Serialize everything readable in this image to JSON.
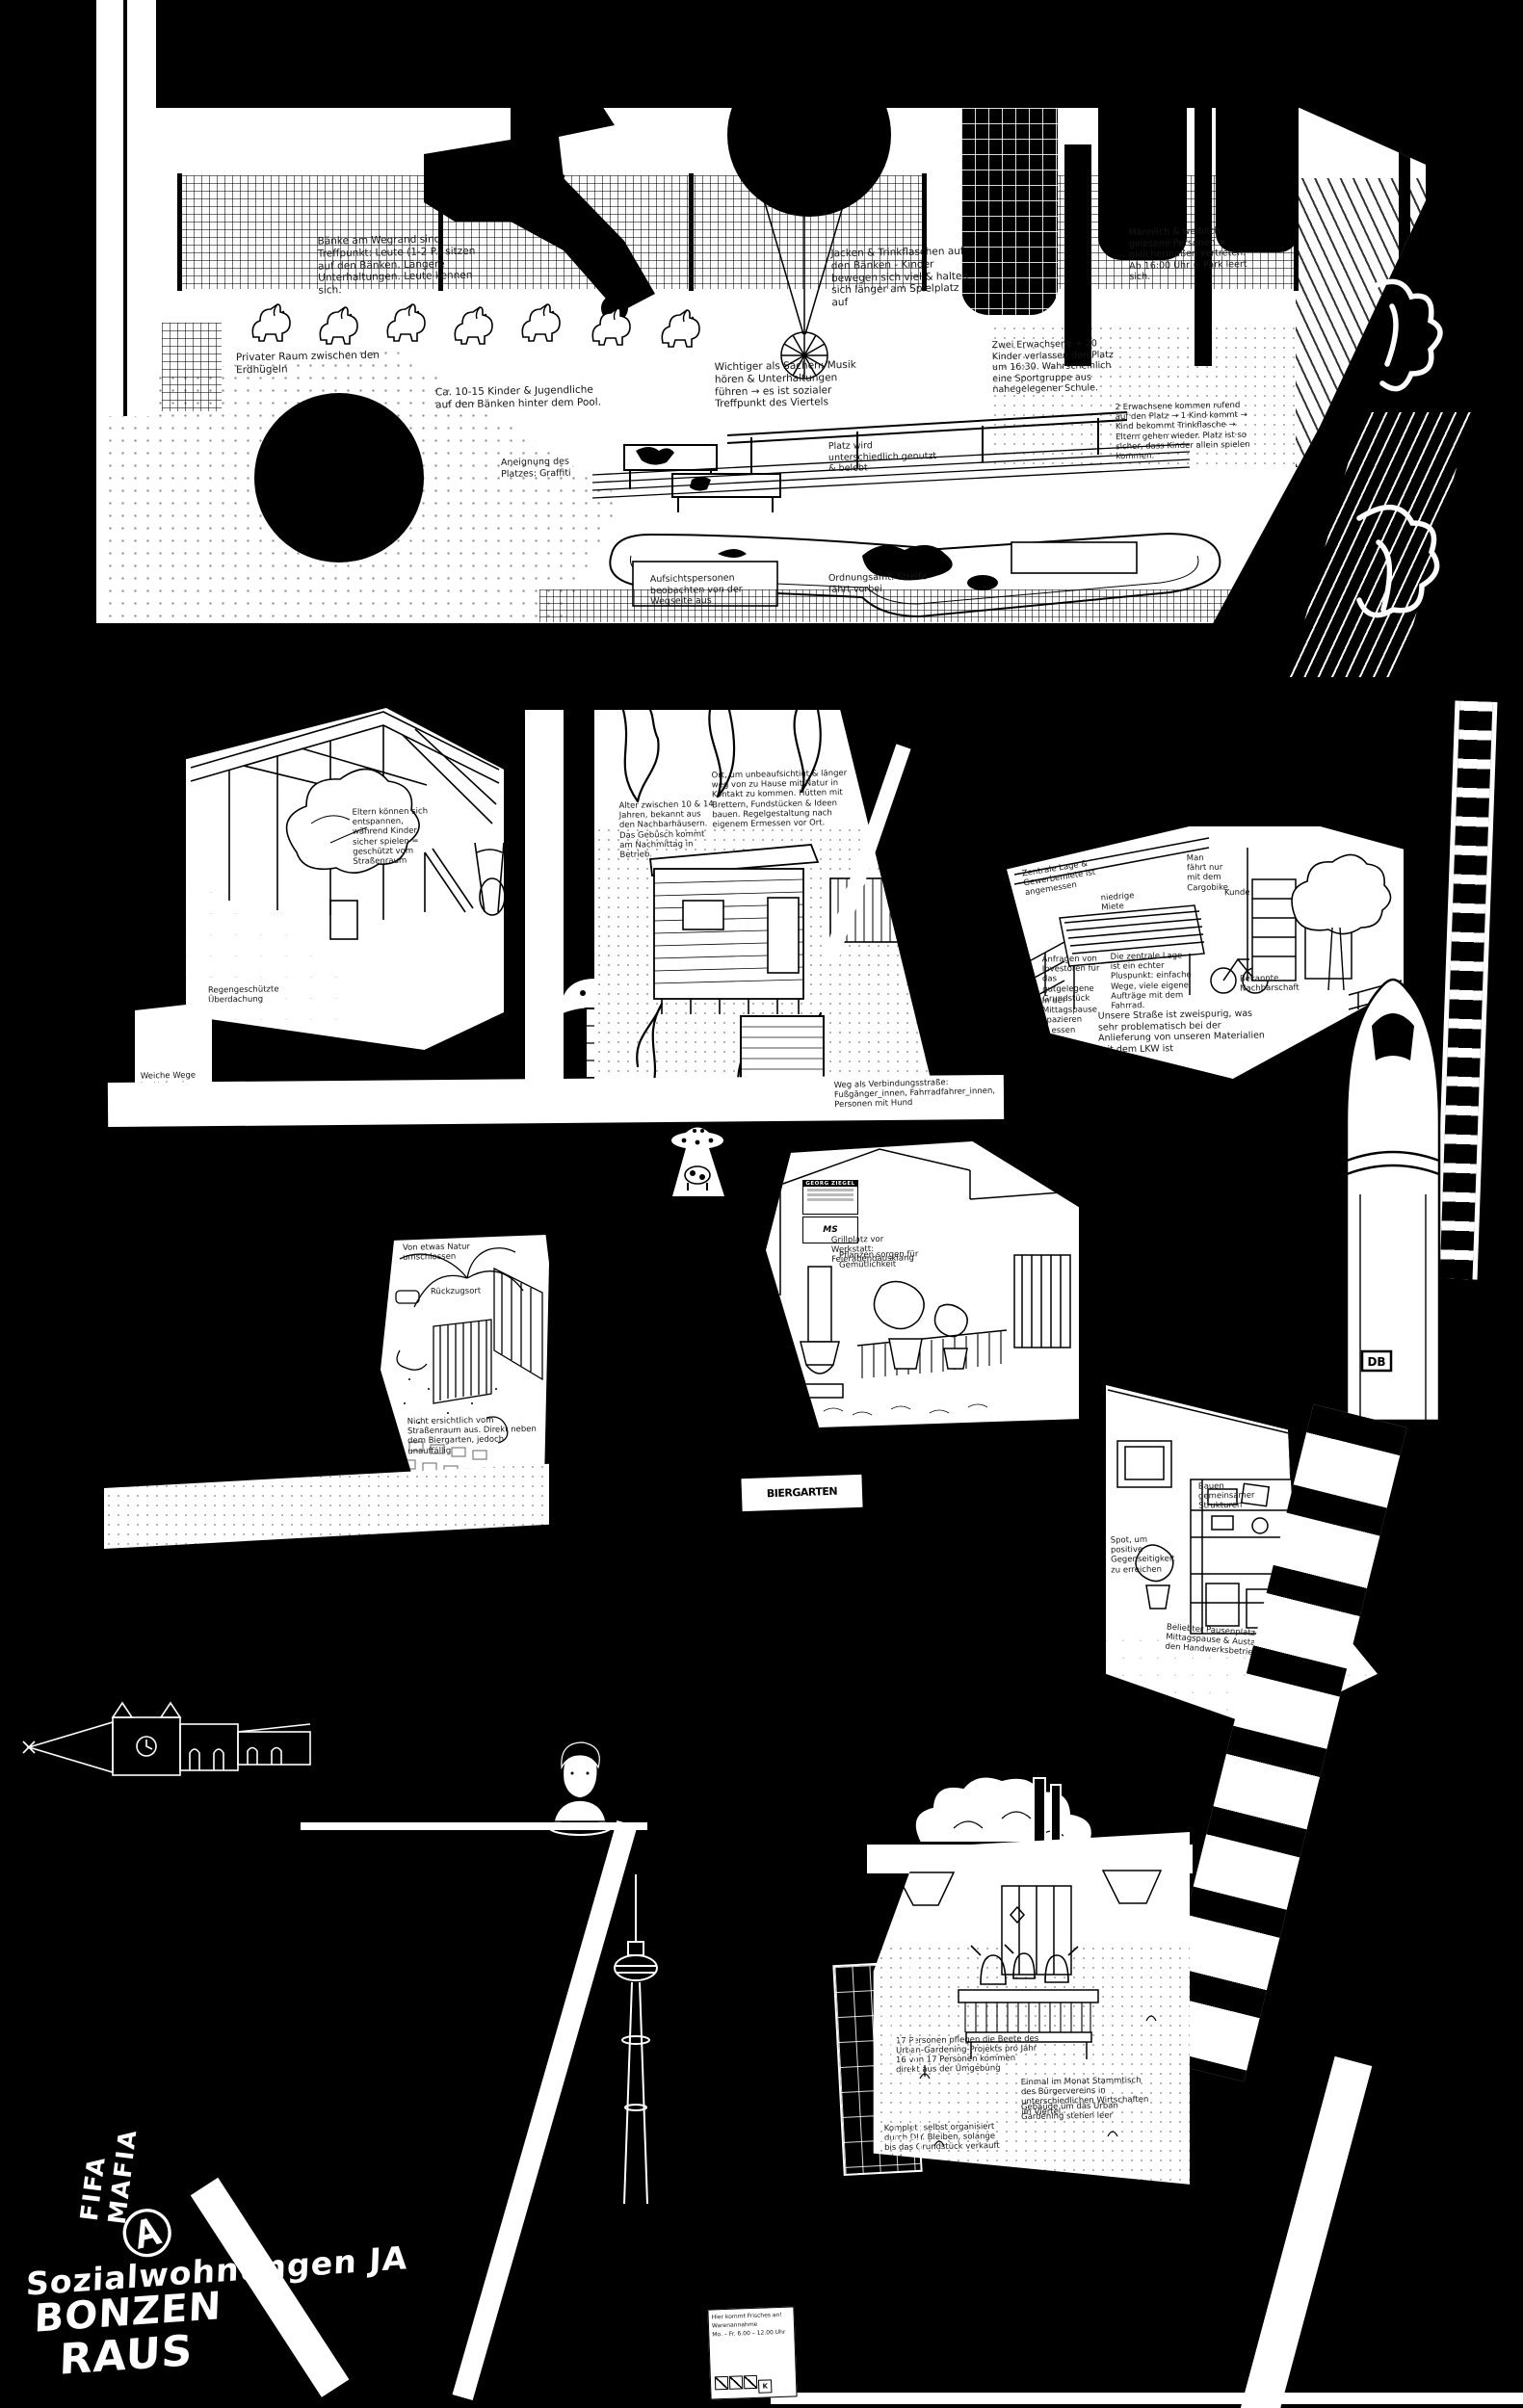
{
  "colors": {
    "background": "#000000",
    "paper": "#ffffff",
    "ink": "#161616"
  },
  "park": {
    "horses_count": 7,
    "notes": {
      "benches": "Bänke am Wegrand sind Treffpunkt: Leute (1-2 P.) sitzen auf den Bänken. Längere Unterhaltungen. Leute kennen sich.",
      "private": "Privater Raum zwischen den Erdhügeln",
      "kids": "Ca. 10-15 Kinder & Jugendliche auf den Bänken hinter dem Pool.",
      "jackets": "Jacken & Trinkflaschen auf den Bänken - Kinder bewegen sich viel & halten sich länger am Spielplatz auf",
      "treffpunkt": "Wichtiger als Sachen: Musik hören & Unterhaltungen führen → es ist sozialer Treffpunkt des Viertels",
      "sportgruppe": "Zwei Erwachsene + 20 Kinder verlassen den Platz um 16:30. Wahrscheinlich eine Sportgruppe aus nahegelegener Schule.",
      "eltern": "2 Erwachsene kommen rufend auf den Platz → 1 Kind kommt → Kind bekommt Trinkflasche → Eltern gehen wieder. Platz ist so sicher, dass Kinder allein spielen kommen.",
      "gender": "Männlich & weiblich gelesene Personen = gleichermaßen vertreten. Ab 16:00 Uhr = Park leert sich.",
      "nutzung": "Platz wird unterschiedlich genutzt & belebt",
      "graffiti": "Aneignung des Platzes: Graffiti",
      "aufsicht": "Aufsichtspersonen beobachten von der Wegseite aus",
      "ordnungsamt": "Ordnungsamt: Streife fährt vorbei"
    }
  },
  "hof": {
    "notes": {
      "eltern": "Eltern können sich entspannen, während Kinder sicher spielen = geschützt vom Straßenraum",
      "dach": "Regengeschützte Überdachung",
      "wege": "Weiche Wege im Hof, sehr verborgen"
    }
  },
  "versteck": {
    "notes": {
      "ort": "Ort, um unbeaufsichtigt & länger weg von zu Hause mit Natur in Kontakt zu kommen. Hütten mit Brettern, Fundstücken & Ideen bauen. Regelgestaltung nach eigenem Ermessen vor Ort.",
      "alter": "Alter zwischen 10 & 14 Jahren, bekannt aus den Nachbarhäusern. Das Gebüsch kommt am Nachmittag in Betrieb."
    }
  },
  "weg": {
    "notes": {
      "verbindung": "Weg als Verbindungsstraße: Fußgänger_innen, Fahrradfahrer_innen, Personen mit Hund"
    }
  },
  "werkstatt": {
    "notes": {
      "lage": "Zentrale Lage & Gewerbemiete ist angemessen",
      "miete": "niedrige Miete",
      "cargo": "Man fährt nur mit dem Cargobike",
      "kunde": "Kunde",
      "anfragen": "Anfragen von Investoren für das gutgelegene Grundstück",
      "plus": "Die zentrale Lage ist ein echter Pluspunkt: einfache Wege, viele eigene Aufträge mit dem Fahrrad.",
      "nachbarschaft": "Bekannte Nachbarschaft",
      "mittag": "In der Mittagspause spazieren & essen",
      "lkw": "Unsere Straße ist zweispurig, was sehr problematisch bei der Anlieferung von unseren Materialien mit dem LKW ist"
    }
  },
  "garten": {
    "notes": {
      "natur": "Von etwas Natur umschlossen",
      "rueckzug": "Rückzugsort",
      "versteckt": "Nicht ersichtlich vom Straßenraum aus. Direkt neben dem Biergarten, jedoch unauffällig",
      "alle": "Für Groß & Klein"
    }
  },
  "grillplatz": {
    "sign": {
      "title": "GEORG ZIEGEL",
      "logo": "MS"
    },
    "biergarten_sign": "BIERGARTEN",
    "notes": {
      "grill": "Grillplatz vor Werkstatt: Feierabendausklang",
      "pflanzen": "Pflanzen sorgen für Gemütlichkeit"
    }
  },
  "gemeinschaftsraum": {
    "notes": {
      "bauen": "Bauen gemeinsamer Strukturen",
      "spot": "Spot, um positive Gegenseitigkeit zu erreichen",
      "pause": "Beliebter Pausenplatz in der Mittagspause & Austausch zwischen den Handwerksbetrieben"
    }
  },
  "urban_gardening": {
    "notes": {
      "pflege": "17 Personen pflegen die Beete des Urban-Gardening-Projekts pro Jahr",
      "herkunft": "16 von 17 Personen kommen direkt aus der Umgebung",
      "stammtisch": "Einmal im Monat Stammtisch des Bürgervereins in unterschiedlichen Wirtschaften im Viertel.",
      "leerstand": "Gebäude um das Urban Gardening stehen leer",
      "diy": "Komplett selbst organisiert durch DIY. Bleiben, solange bis das Grundstück verkauft wird."
    }
  },
  "warenannahme_schild": {
    "line1": "Hier kommt Frisches an!",
    "line2": "Warenannahme",
    "line3": "Mo. – Fr. 6.00 – 12.00 Uhr",
    "icons": [
      "no-smoking-icon",
      "no-dogs-icon",
      "no-parking-icon",
      "brand-icon"
    ]
  },
  "zug": {
    "logo": "DB"
  },
  "graffiti": {
    "slogan_line1": "Sozialwohnungen JA",
    "slogan_line2": "BONZEN",
    "slogan_line3": "RAUS",
    "side_tag": "FIFA MAFIA",
    "anarchy": "Ⓐ"
  }
}
